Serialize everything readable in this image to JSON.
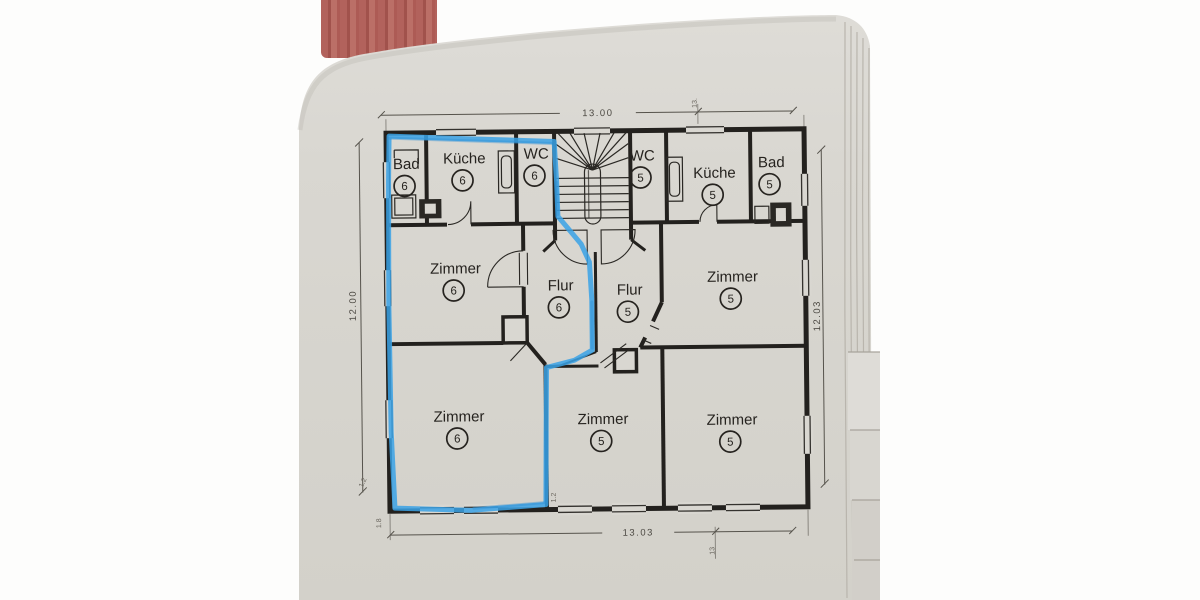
{
  "photo": {
    "description": "photograph of a paper floor plan in a bound document",
    "background_color": "#fdfdfc",
    "page_color": "#d9d7d1",
    "folder_color": "#b2625c",
    "ink_color": "#23211e",
    "highlight_color": "#39a2e6"
  },
  "plan": {
    "rooms": [
      {
        "id": "bad-6",
        "label": "Bad",
        "number": "6"
      },
      {
        "id": "kueche-6",
        "label": "Küche",
        "number": "6"
      },
      {
        "id": "wc-6",
        "label": "WC",
        "number": "6"
      },
      {
        "id": "wc-5",
        "label": "WC",
        "number": "5"
      },
      {
        "id": "kueche-5",
        "label": "Küche",
        "number": "5"
      },
      {
        "id": "bad-5",
        "label": "Bad",
        "number": "5"
      },
      {
        "id": "zimmer-6-mitte",
        "label": "Zimmer",
        "number": "6"
      },
      {
        "id": "flur-6",
        "label": "Flur",
        "number": "6"
      },
      {
        "id": "flur-5",
        "label": "Flur",
        "number": "5"
      },
      {
        "id": "zimmer-5-mitte",
        "label": "Zimmer",
        "number": "5"
      },
      {
        "id": "zimmer-6-unten",
        "label": "Zimmer",
        "number": "6"
      },
      {
        "id": "zimmer-5-unten-mitte",
        "label": "Zimmer",
        "number": "5"
      },
      {
        "id": "zimmer-5-unten-rechts",
        "label": "Zimmer",
        "number": "5"
      }
    ],
    "dimensions": {
      "top": "13.00",
      "bottom": "13.03",
      "left": "12.00",
      "right": "12.03",
      "top_right_small": "13.",
      "bottom_right_small": "13",
      "small_ticks": [
        "1.2",
        "1.8",
        "1.2"
      ]
    },
    "highlight_meaning": "blue marker outline around apartment 6"
  }
}
